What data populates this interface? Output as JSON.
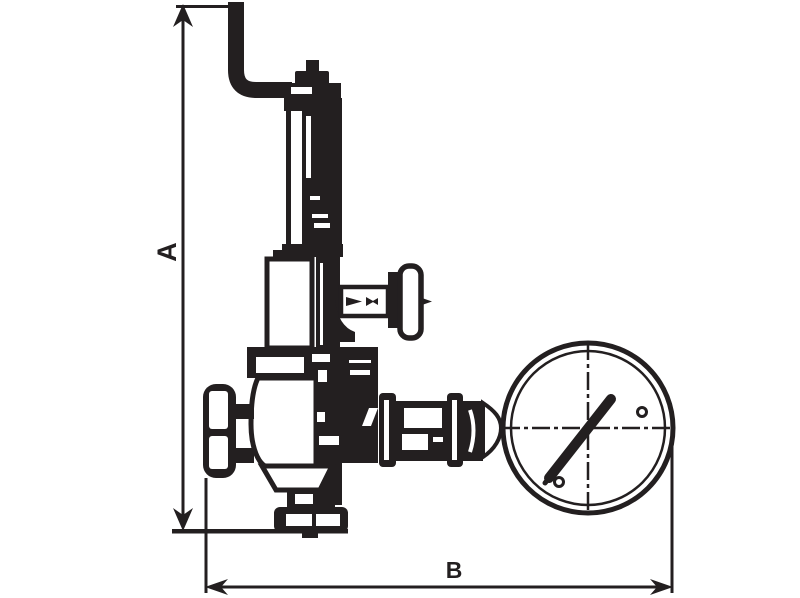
{
  "diagram": {
    "type": "technical-line-drawing",
    "subject": "pressure-reducing-valve-with-gauge",
    "colors": {
      "line": "#231f20",
      "background": "#ffffff"
    },
    "dimension_a": {
      "label": "A",
      "orientation": "vertical"
    },
    "dimension_b": {
      "label": "B",
      "orientation": "horizontal"
    },
    "parts": [
      "inlet-elbow-pipe",
      "adjusting-cap",
      "spring-housing",
      "bonnet-chamber",
      "side-adjustment-knob",
      "valve-body",
      "inlet-handwheel",
      "bottom-drain-cap",
      "outlet-fittings",
      "pressure-gauge",
      "gauge-needle"
    ]
  }
}
